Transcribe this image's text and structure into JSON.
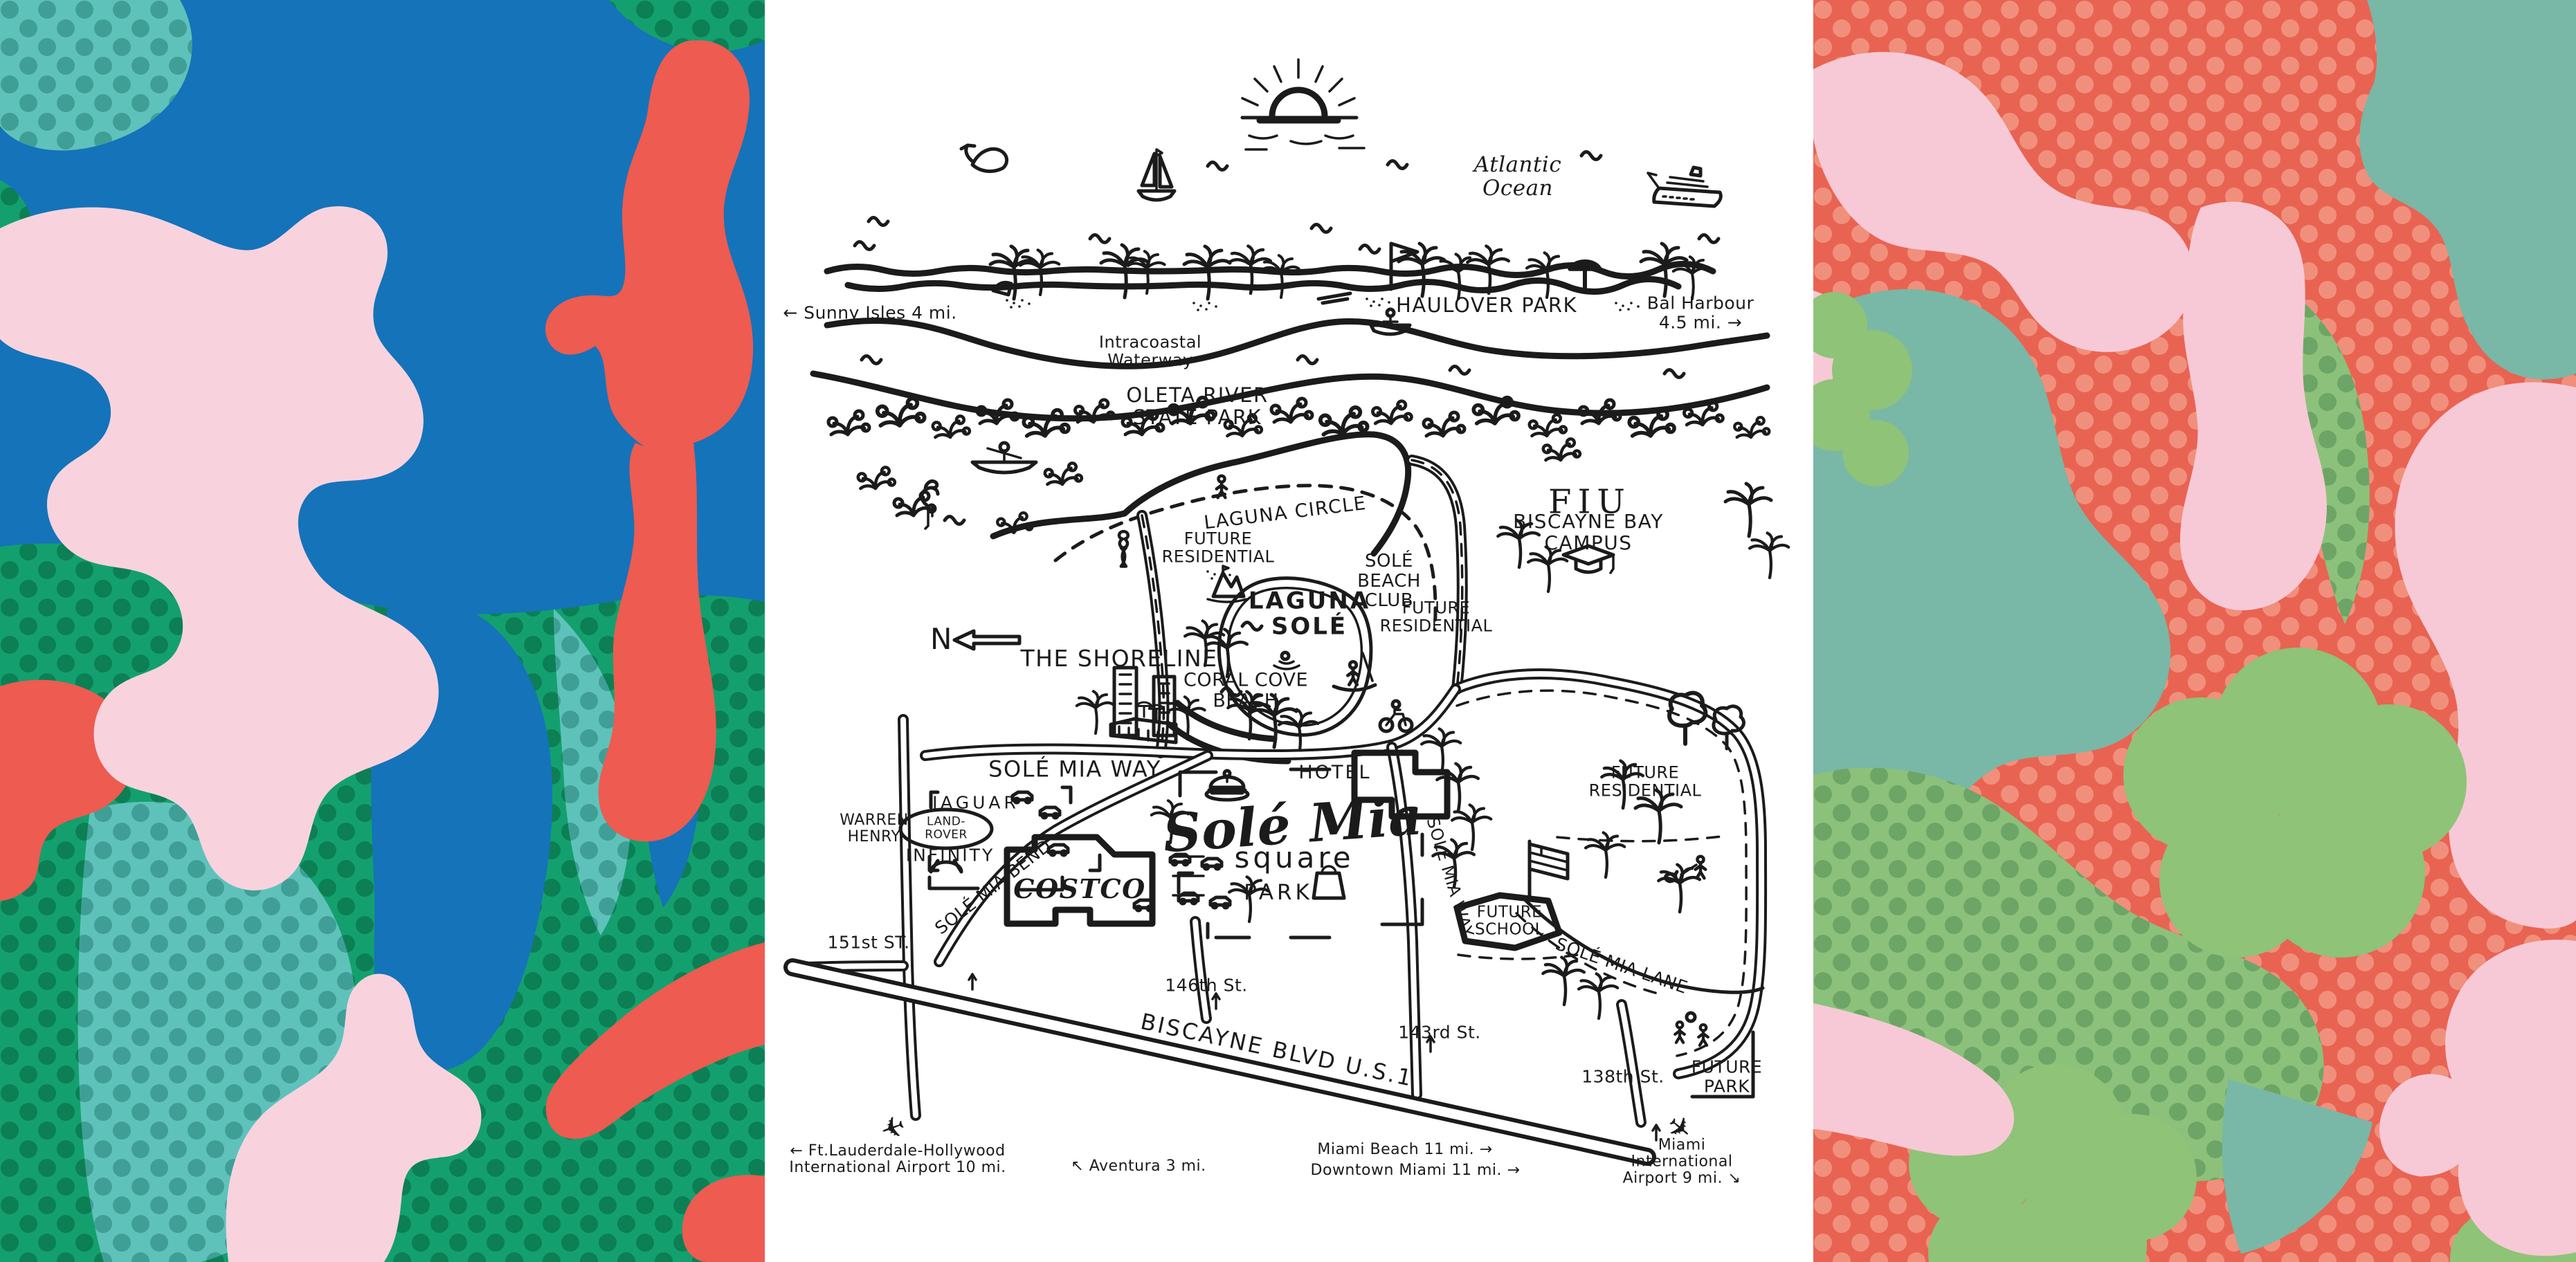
{
  "artwork": {
    "left_panel": {
      "description": "abstract coral shapes with halftone dots",
      "background": "#1573b9",
      "colors": {
        "pink": "#f8d3de",
        "red": "#ee5b50",
        "green": "#13a06e",
        "green_dot": "#0c7f55",
        "teal": "#5fc2ba",
        "teal_dot": "#3f9f97",
        "blue": "#1573b9"
      }
    },
    "right_panel": {
      "description": "abstract clouds and clovers with halftone dots",
      "background": "#e96352",
      "colors": {
        "salmon_dot": "#f0907c",
        "pink": "#f7c9d6",
        "sage": "#79b7a7",
        "green": "#8ec378",
        "green_field": "#8cc17b",
        "green_dot": "#6da566"
      }
    }
  },
  "map": {
    "ink": "#1b1b1b",
    "background": "#ffffff",
    "labels": {
      "atlantic": "Atlantic\nOcean",
      "sunny_isles": "← Sunny Isles  4 mi.",
      "haulover": "HAULOVER PARK",
      "bal_harbour": "Bal Harbour  4.5 mi. →",
      "intracoastal": "Intracoastal\nWaterway",
      "oleta": "OLETA RIVER\nSTATE PARK",
      "laguna_circle": "LAGUNA CIRCLE",
      "fiu": "FIU",
      "fiu_campus": "BISCAYNE BAY CAMPUS",
      "future_residential_nw": "FUTURE\nRESIDENTIAL",
      "sole_beach_club": "SOLÉ\nBEACH\nCLUB",
      "laguna_sole": "LAGUNA\nSOLÉ",
      "future_residential_ne": "FUTURE\nRESIDENTIAL",
      "compass_n": "N",
      "the_shoreline": "THE SHORELINE",
      "coral_cove": "CORAL COVE\nBEACH",
      "sole_mia_way_top": "SOLÉ MIA WAY",
      "hotel": "HOTEL",
      "jaguar": "JAGUAR",
      "land_rover": "LAND-\nROVER",
      "warren_henry": "WARREN\nHENRY",
      "infinity": "INFINITY",
      "sole_mia": "Solé Mia",
      "square_word": "square",
      "sole_mia_bend": "SOLÉ MIA BEND",
      "costco": "COSTCO",
      "park": "PARK",
      "future_residential_e": "FUTURE\nRESIDENTIAL",
      "sole_mia_way_south": "SOLÉ MIA WAY",
      "future_school": "FUTURE\nSCHOOL",
      "sole_mia_lane": "SOLÉ MIA LANE",
      "st_151": "151st ST.",
      "st_146": "146th St.",
      "biscayne_blvd": "BISCAYNE BLVD   U.S.1",
      "st_143": "143rd St.",
      "st_138": "138th St.",
      "future_park": "FUTURE\nPARK",
      "ftl_airport": "← Ft.Lauderdale-Hollywood\nInternational Airport  10 mi.",
      "aventura": "↖ Aventura  3 mi.",
      "miami_beach": "Miami Beach  11 mi. →",
      "downtown_miami": "Downtown Miami  11 mi. →",
      "miami_airport": "Miami\nInternational Airport  9 mi. ↘"
    },
    "icons": {
      "airplane_glyph": "✈"
    }
  }
}
